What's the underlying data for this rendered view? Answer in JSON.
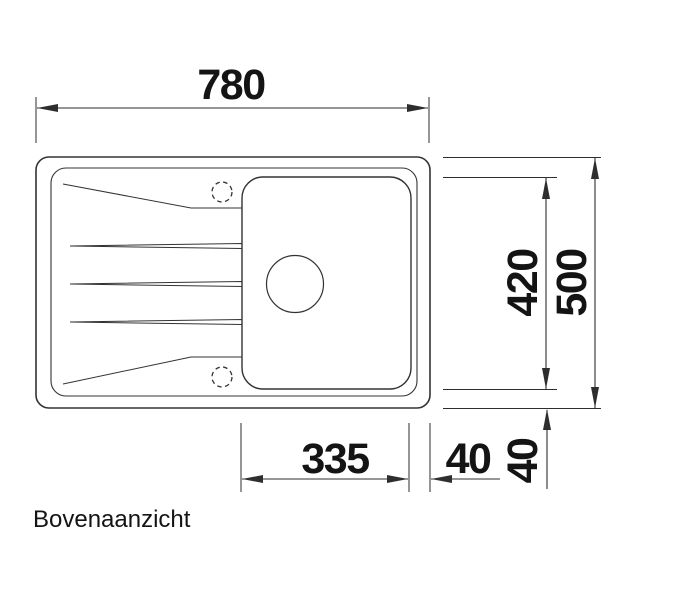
{
  "drawing": {
    "title": "Bovenaanzicht",
    "type_hint": "sink-top-view-technical-drawing",
    "dims": {
      "overall_width": "780",
      "overall_depth": "500",
      "inner_depth": "420",
      "bowl_width": "335",
      "bowl_side_offset": "40",
      "bowl_bottom_offset": "40"
    },
    "colors": {
      "background": "#ffffff",
      "line": "#2e2e2e",
      "text": "#141414"
    }
  }
}
